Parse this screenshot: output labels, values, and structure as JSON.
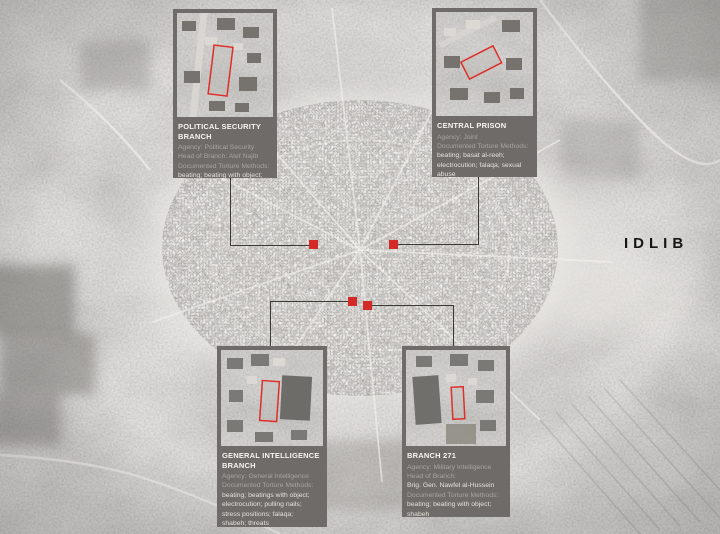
{
  "page": {
    "region_label": "IDLIB"
  },
  "colors": {
    "marker_red": "#d22b27",
    "outline_red": "#dd2f2a",
    "box_bg": "#6e6b69",
    "connector": "#3c3a37",
    "title_text": "#f7f5f1",
    "label_text": "#a9a49d",
    "value_text": "#e6e2dc"
  },
  "callouts": [
    {
      "id": "political-security-branch",
      "title": "POLITICAL SECURITY BRANCH",
      "body": [
        {
          "text": "Agency: Political Security",
          "tone": "label"
        },
        {
          "text": "Head of Branch: Atef Najib",
          "tone": "label"
        },
        {
          "text": "Documented Torture Methods:",
          "tone": "label"
        },
        {
          "text": "beating; beating with object;",
          "tone": "value"
        },
        {
          "text": "electrocution; basat al-reeh",
          "tone": "value"
        }
      ]
    },
    {
      "id": "central-prison",
      "title": "CENTRAL PRISON",
      "body": [
        {
          "text": "Agency: Joint",
          "tone": "label"
        },
        {
          "text": "Documented Torture Methods:",
          "tone": "label"
        },
        {
          "text": "beating; basat al-reeh;",
          "tone": "value"
        },
        {
          "text": "electrocution; falaqa; sexual",
          "tone": "value"
        },
        {
          "text": "abuse",
          "tone": "value"
        }
      ]
    },
    {
      "id": "general-intelligence-branch",
      "title": "GENERAL INTELLIGENCE BRANCH",
      "body": [
        {
          "text": "Agency: General Intelligence",
          "tone": "label"
        },
        {
          "text": "Documented Torture Methods:",
          "tone": "label"
        },
        {
          "text": "beating; beatings with object;",
          "tone": "value"
        },
        {
          "text": "electrocution; pulling nails;",
          "tone": "value"
        },
        {
          "text": "stress positions; falaqa;",
          "tone": "value"
        },
        {
          "text": "shabeh; threats",
          "tone": "value"
        }
      ]
    },
    {
      "id": "branch-271",
      "title": "BRANCH 271",
      "body": [
        {
          "text": "Agency: Military Intelligence",
          "tone": "label"
        },
        {
          "text": "Head of Branch:",
          "tone": "label"
        },
        {
          "text": "Brig. Gen. Nawfel al-Hussein",
          "tone": "value"
        },
        {
          "text": "Documented Torture Methods:",
          "tone": "label"
        },
        {
          "text": "beating; beating with object;",
          "tone": "value"
        },
        {
          "text": "shabeh",
          "tone": "value"
        }
      ]
    }
  ],
  "markers": [
    {
      "name": "political-security-branch-marker"
    },
    {
      "name": "central-prison-marker"
    },
    {
      "name": "general-intelligence-branch-marker"
    },
    {
      "name": "branch-271-marker"
    }
  ]
}
